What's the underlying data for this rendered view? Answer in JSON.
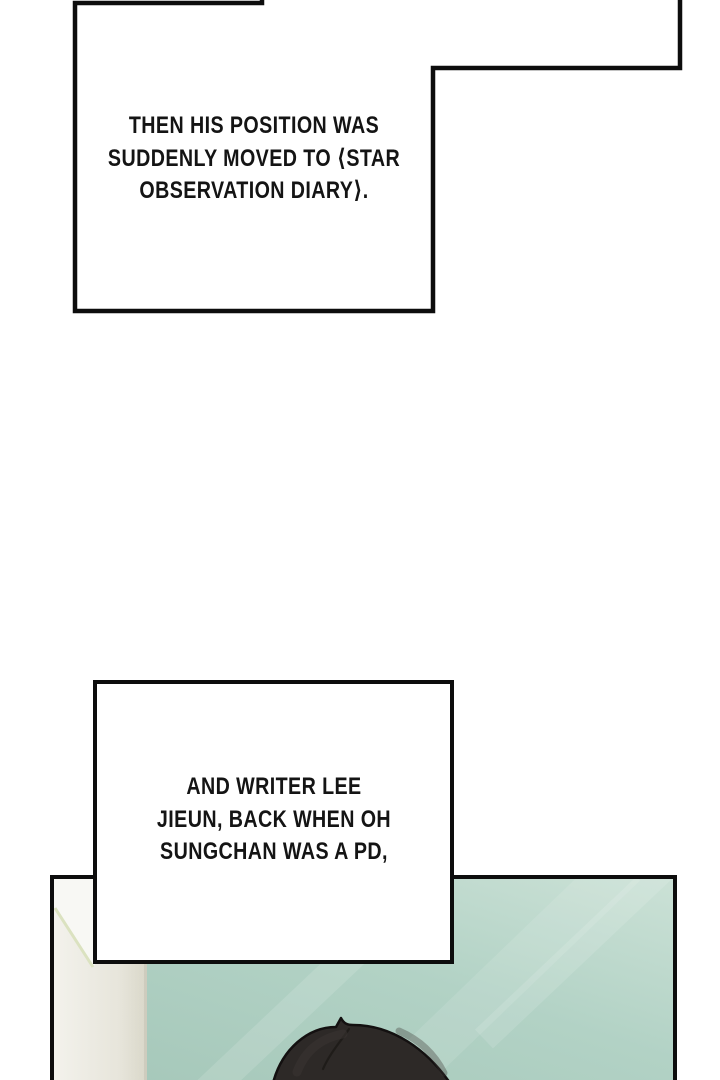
{
  "comic": {
    "caption1": {
      "lines": [
        "THEN HIS POSITION WAS",
        "SUDDENLY MOVED TO ⟨STAR",
        "OBSERVATION DIARY⟩."
      ]
    },
    "caption2": {
      "lines": [
        "AND WRITER LEE",
        "JIEUN, BACK WHEN OH",
        "SUNGCHAN WAS A PD,"
      ]
    }
  },
  "colors": {
    "ink": "#0d0d0d",
    "paper": "#ffffff",
    "text": "#141414",
    "wall_mint": "#b2d2c5",
    "wall_mint_dark": "#a5c7b9",
    "wall_mint_light": "#cbe1d6",
    "door_frame": "#e7e5db",
    "door_frame_bright": "#f8f8f4",
    "door_frame_accent": "#dbe2c0",
    "door_frame_edge": "#c7c5b6",
    "hair_dark": "#2d2927",
    "hair_outline": "#131010",
    "hair_crease": "#1b1815",
    "hair_highlight": "#3b3634"
  }
}
